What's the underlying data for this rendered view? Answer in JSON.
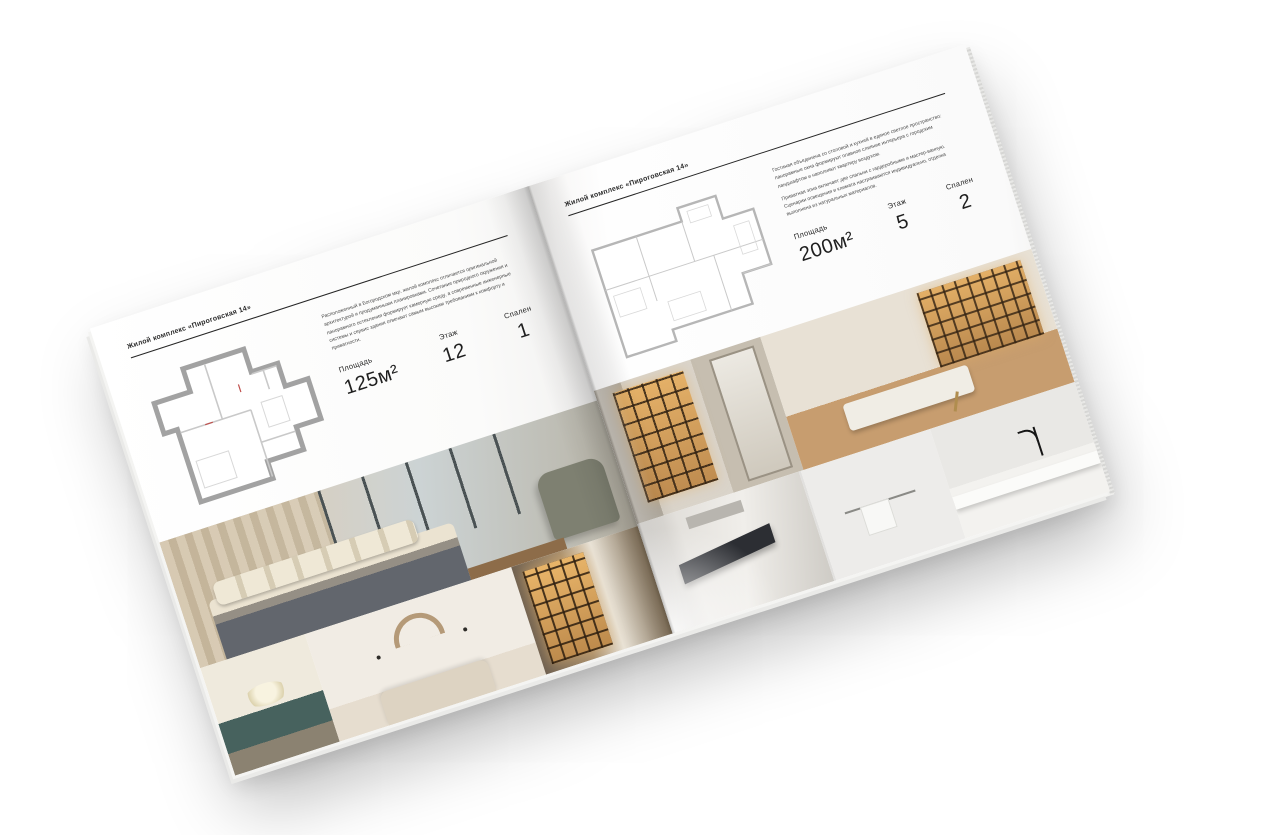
{
  "brochure": {
    "title": "Жилой комплекс «Пироговская 14»"
  },
  "left_page": {
    "header": "Жилой комплекс «Пироговская 14»",
    "description": "Расположенный в Богородском мкр. жилой комплекс отличается оригинальной архитектурой и продуманными планировками. Сочетание природного окружения и панорамного остекления формирует камерную среду, а современные инженерные системы и сервис здания отвечают самым высоким требованиям к комфорту и приватности.",
    "stats": {
      "area_label": "Площадь",
      "area_value": "125м²",
      "floor_label": "Этаж",
      "floor_value": "12",
      "bedrooms_label": "Спален",
      "bedrooms_value": "1"
    }
  },
  "right_page": {
    "header": "Жилой комплекс «Пироговская 14»",
    "description_1": "Гостиная объединена со столовой и кухней в единое светлое пространство: панорамные окна формируют плавное слияние интерьера с городским ландшафтом и наполняют квартиру воздухом.",
    "description_2": "Приватная зона включает две спальни с гардеробными и мастер-ванную. Сценарии освещения и климата настраиваются индивидуально, отделка выполнена из натуральных материалов.",
    "stats": {
      "area_label": "Площадь",
      "area_value": "200м²",
      "floor_label": "Этаж",
      "floor_value": "5",
      "bedrooms_label": "Спален",
      "bedrooms_value": "2"
    }
  },
  "palette": {
    "paper": "#ffffff",
    "ink": "#262626",
    "plan_wall_gray": "#a6a6a6",
    "shelf_glow": "#e0aa5f",
    "teal_accent": "#47625e",
    "wood": "#b98d5f"
  }
}
